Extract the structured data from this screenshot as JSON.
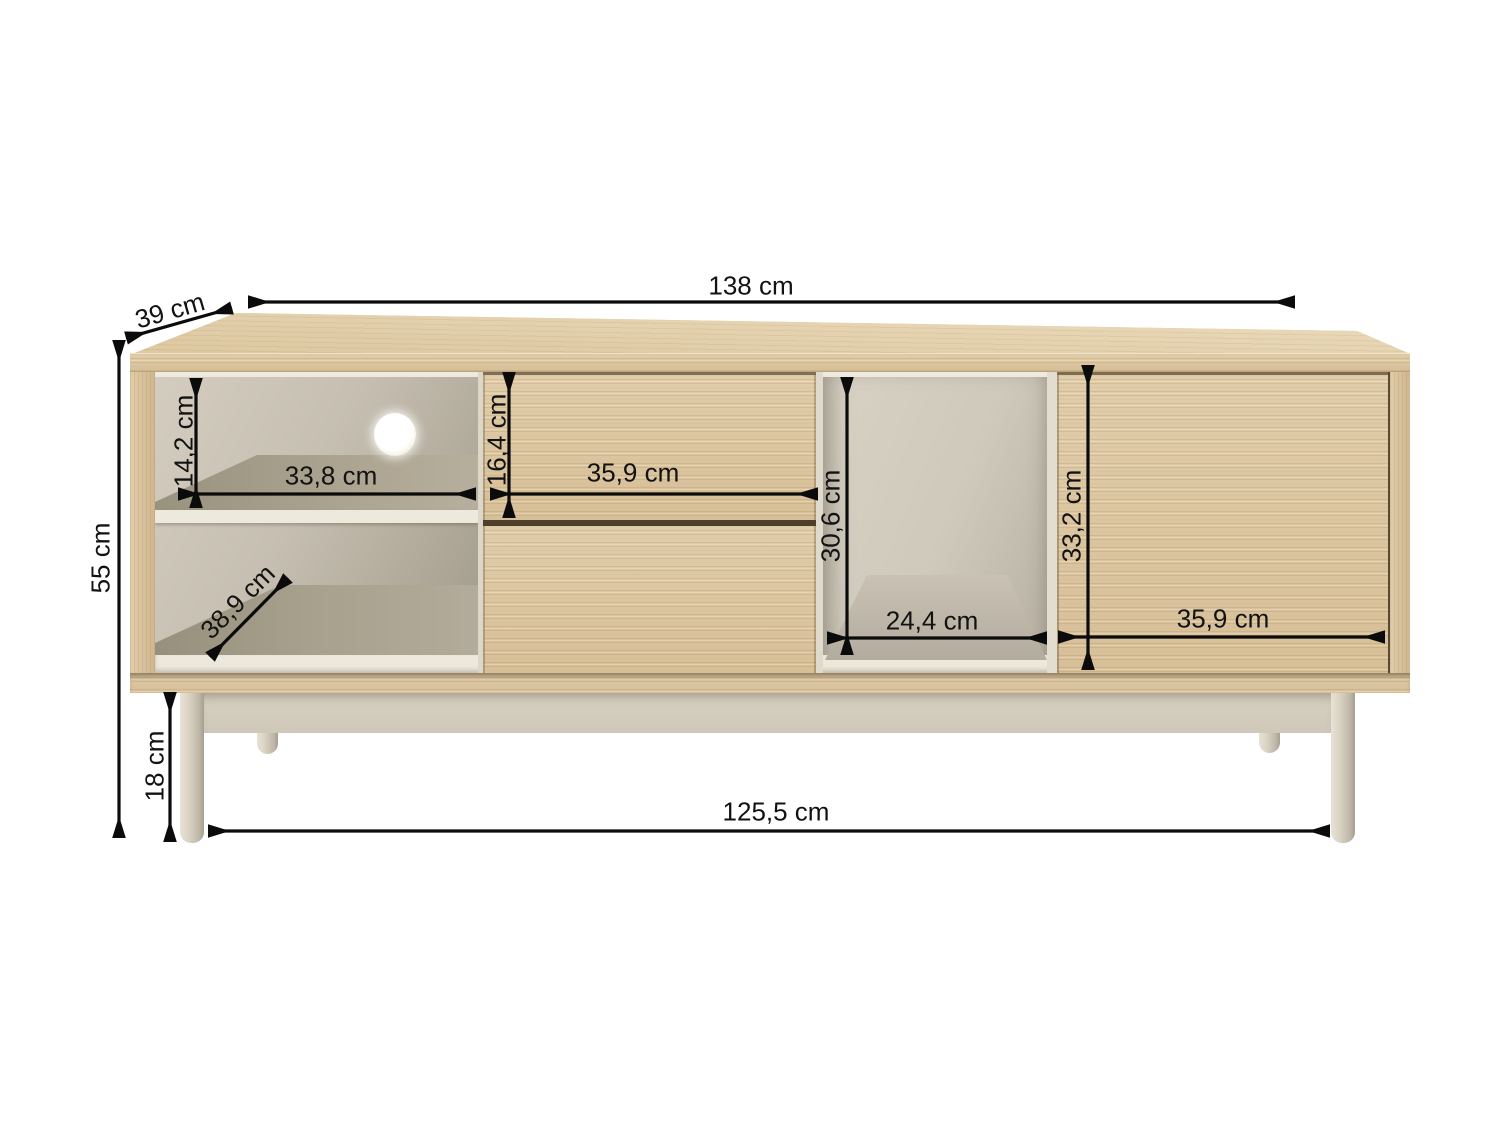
{
  "diagram": {
    "unit": "cm",
    "labels": {
      "width_total": "138 cm",
      "depth": "39 cm",
      "height_total": "55 cm",
      "shelf_opening_height": "14,2 cm",
      "shelf_opening_width": "33,8 cm",
      "shelf_depth": "38,9 cm",
      "drawer_height": "16,4 cm",
      "drawer_width": "35,9 cm",
      "niche_height": "30,6 cm",
      "niche_width": "24,4 cm",
      "door_height": "33,2 cm",
      "door_width": "35,9 cm",
      "leg_height": "18 cm",
      "base_width": "125,5 cm"
    },
    "colors": {
      "wood": "#d9c29c",
      "wood_top": "#e5d3b2",
      "interior_cream": "#d6cfc2",
      "frame_cream": "#d5cec0",
      "dimension_lines": "#0b0b0b",
      "background": "#ffffff"
    }
  }
}
